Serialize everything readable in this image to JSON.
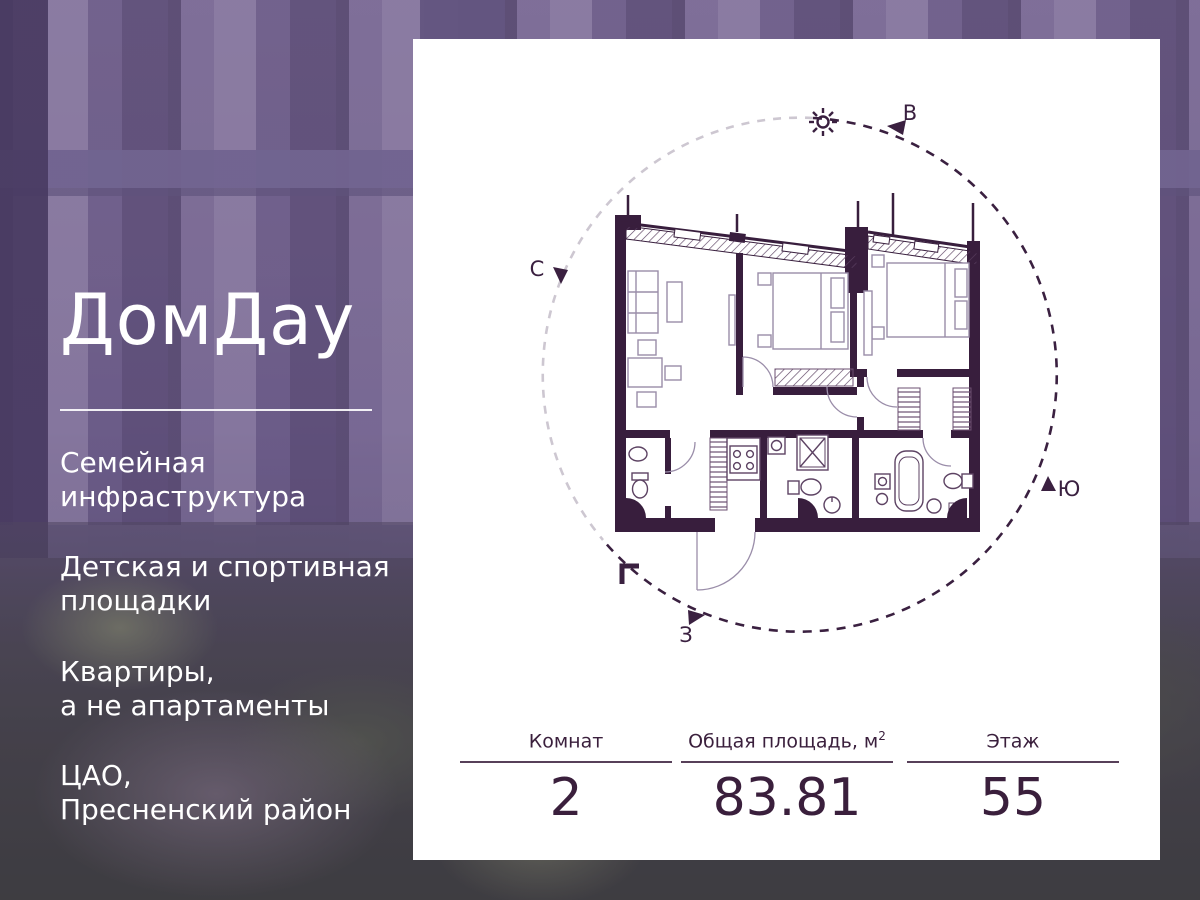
{
  "banner": {
    "left_panel": {
      "logo": "ДомДау",
      "features": [
        "Семейная\nинфраструктура",
        "Детская и спортивная\nплощадки",
        "Квартиры,\nа не апартаменты",
        "ЦАО,\nПресненский район"
      ]
    },
    "card": {
      "compass": {
        "north": "С",
        "east": "В",
        "south": "Ю",
        "west": "З"
      },
      "stats": [
        {
          "label": "Комнат",
          "value": "2"
        },
        {
          "label": "Общая площадь, м",
          "label_sup": "2",
          "value": "83.81"
        },
        {
          "label": "Этаж",
          "value": "55"
        }
      ]
    },
    "colors": {
      "accent": "#3a1f3c",
      "card_bg": "#ffffff",
      "text_on_photo": "#ffffff",
      "plan_furniture_line": "#9a8da9"
    }
  }
}
